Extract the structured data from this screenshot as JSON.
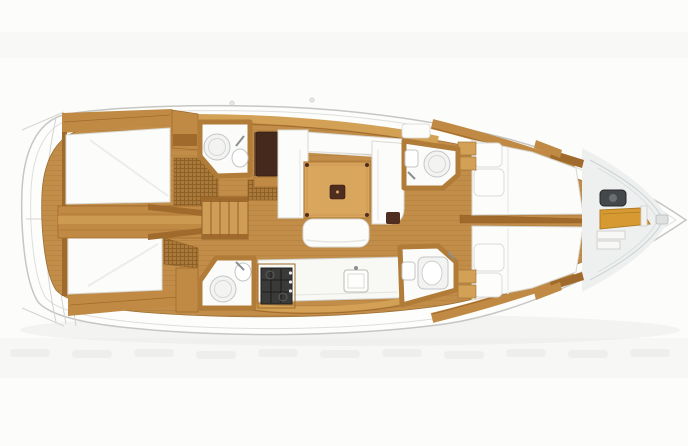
{
  "diagram": {
    "type": "sailboat-interior-deck-plan",
    "orientation": "bow-right",
    "areas": [
      "swim-platform",
      "aft-cabin-port",
      "aft-cabin-starboard",
      "engine-compartment",
      "companionway-steps",
      "aft-head-port",
      "aft-head-starboard",
      "nav-station",
      "saloon-settee",
      "saloon-table",
      "saloon-bench",
      "galley",
      "stove",
      "sink",
      "forward-cabin-port",
      "forward-cabin-starboard",
      "forward-head-port",
      "forward-head-starboard",
      "anchor-locker",
      "bow"
    ]
  },
  "colors": {
    "background": "#fcfcfb",
    "ambient_band": "#f4f4f2",
    "shadow": "#ebebe9",
    "smudge": "#eeeeec",
    "hull": "#fdfdfc",
    "hull_stroke": "#c6c6c3",
    "deck_line": "#dededb",
    "platform_line": "#d3d3d0",
    "wood_base": "#c28d49",
    "wood_mid": "#c08a45",
    "wood_light": "#d2a155",
    "wood_dark": "#a06a2c",
    "plank": "#aa7a38",
    "grate_bg": "#ab7a3a",
    "grate_line": "#8a5e26",
    "upholstery": "#fcfcfa",
    "upholstery_stroke": "#d9d9d5",
    "seam": "#ececea",
    "head_white": "#fbfbf9",
    "head_frame": "#b07c38",
    "fixture_stroke": "#c3c6c6",
    "fixture_fill": "#f3f3f1",
    "faucet": "#8a8f94",
    "table_wood": "#d9a65e",
    "table_trim": "#b17c37",
    "table_dark": "#4f2d1f",
    "nav_dark": "#46291d",
    "nav_edge": "#7a5638",
    "stove_dark": "#3a3a38",
    "stove_grid": "#141414",
    "counter_white": "#f8f8f5",
    "counter_stroke": "#cfcfcb",
    "bow_orange": "#d79a33",
    "bow_orange_edge": "#b07d22",
    "windlass": "#44484a",
    "forepeak": "#eef0f0",
    "forepeak_line": "#ccd2d3",
    "steps_wood": "#cf9d55",
    "steps_line": "#8f6327"
  }
}
